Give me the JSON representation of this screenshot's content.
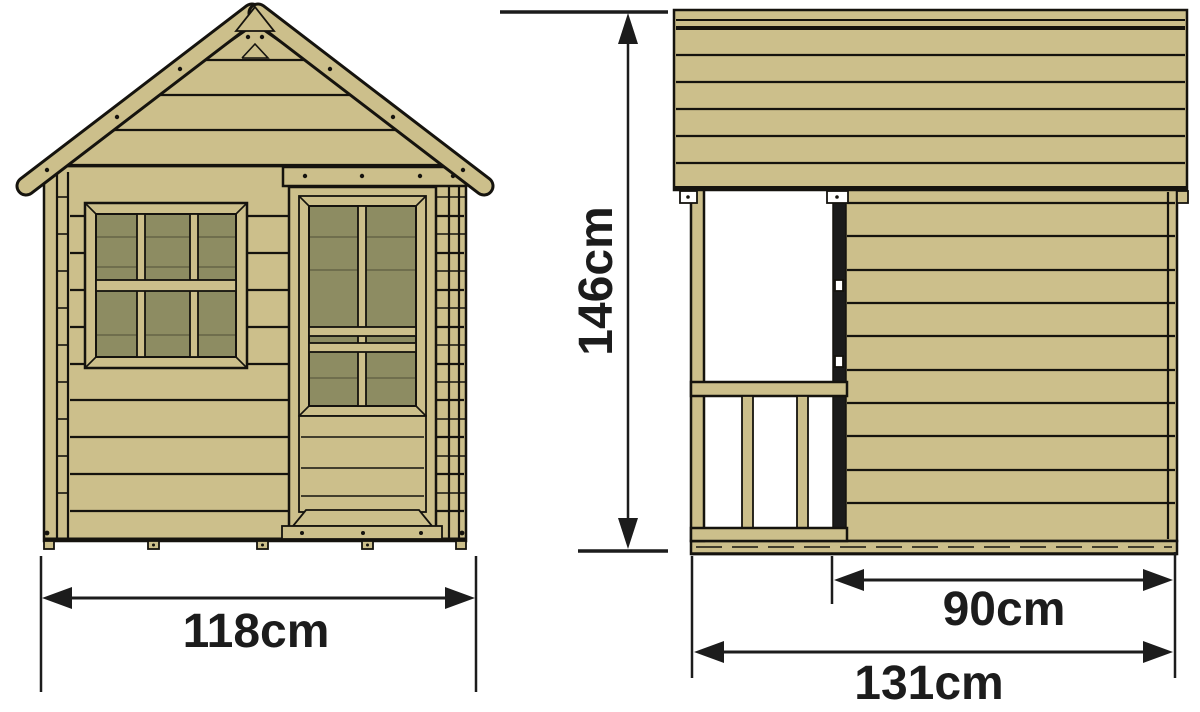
{
  "dimensions": {
    "front_width": "118cm",
    "height": "146cm",
    "side_wall_depth": "90cm",
    "side_total_depth": "131cm"
  },
  "colors": {
    "wood": "#ccbf8b",
    "glass": "#8d8c62",
    "glass_line": "#6f6e4d",
    "outline": "#15130e",
    "door_shadow": "#1b1b1b",
    "dimension": "#1c1c1c",
    "background": "#ffffff"
  }
}
